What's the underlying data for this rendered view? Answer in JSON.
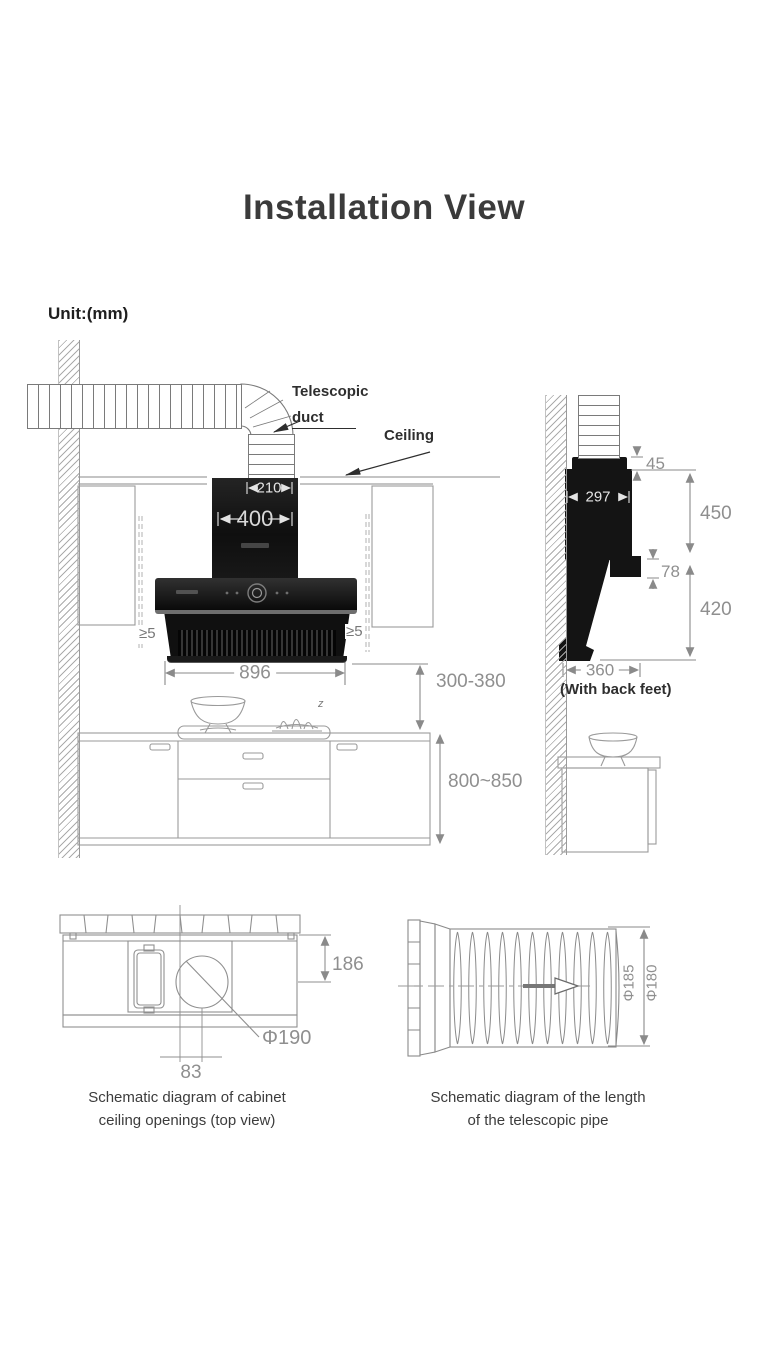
{
  "title": "Installation View",
  "unit_label": "Unit:(mm)",
  "front_view": {
    "labels": {
      "telescopic": "Telescopic",
      "duct": "duct",
      "ceiling": "Ceiling"
    },
    "cooktop_mark": "z",
    "dims": {
      "duct_outlet_width": "210",
      "chimney_width": "400",
      "hood_width": "896",
      "left_clearance": "≥5",
      "right_clearance": "≥5",
      "hood_to_counter": "300-380",
      "counter_height": "800~850"
    }
  },
  "side_view": {
    "note": "(With back feet)",
    "dims": {
      "collar_height": "45",
      "hood_depth": "297",
      "upper_height": "450",
      "bracket_height": "78",
      "lower_height": "420",
      "base_depth": "360"
    }
  },
  "top_view": {
    "caption_line1": "Schematic diagram of cabinet",
    "caption_line2": "ceiling openings (top view)",
    "dims": {
      "opening_depth": "186",
      "hole_diameter": "Φ190",
      "hole_offset": "83"
    }
  },
  "pipe_view": {
    "caption_line1": "Schematic diagram of the length",
    "caption_line2": "of the telescopic pipe",
    "dims": {
      "outer_diameter": "Φ185",
      "inner_diameter": "Φ180"
    }
  },
  "colors": {
    "ink": "#3b3b3b",
    "label_ink": "#2e2e2e",
    "dim_text": "#8f8f8f",
    "line": "#8a8a8a",
    "hood_black": "#141414",
    "white_dim": "#e4e4e4"
  }
}
